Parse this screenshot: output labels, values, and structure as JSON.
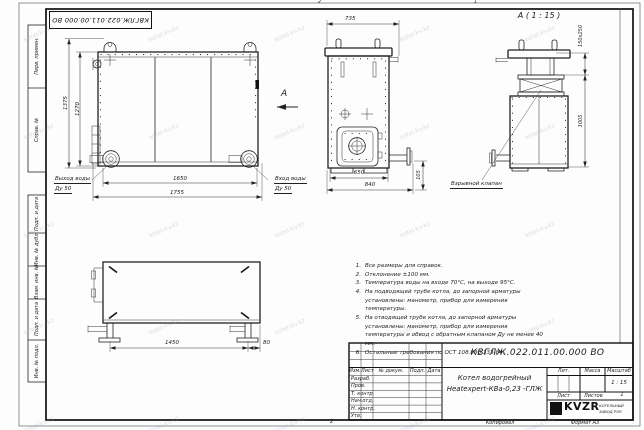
{
  "watermark": "kotel-kv.kz",
  "sheet": {
    "fold_marks": [
      "2",
      "1",
      "2"
    ]
  },
  "margin_labels": [
    "Перв. примен.",
    "Справ. №",
    "Подп. и дата",
    "Инв. № дубл.",
    "Взам. инв. №",
    "Подп. и дата",
    "Инв. № подл."
  ],
  "top_stamp": "КВГЛЖ.022.011.00.000 ВО",
  "front_view": {
    "dim_height_outer": "1375",
    "dim_height_inner": "1270",
    "dim_width_inner": "1650",
    "dim_width_outer": "1755",
    "outlet_line1": "Выход воды",
    "outlet_line2": "Ду 50",
    "inlet_line1": "Вход воды",
    "inlet_line2": "Ду 50",
    "section_arrow": "А"
  },
  "side_view": {
    "dim_top": "735",
    "dim_bottom_inner": "650",
    "dim_bottom_outer": "840",
    "dim_pipe_height": "105"
  },
  "detail_view": {
    "title": "А ( 1 : 15 )",
    "dim_valve": "150x250",
    "dim_body_height": "1005",
    "callout": "Взрывной клапан"
  },
  "plan_view": {
    "dim_feet_span": "1450",
    "dim_edge_offset": "80"
  },
  "notes": [
    {
      "num": "1.",
      "text": "Все размеры для справок."
    },
    {
      "num": "2.",
      "text": "Отклонение ±100 мм."
    },
    {
      "num": "3.",
      "text": "Температура воды на входе 70°С, на выходе 95°С."
    },
    {
      "num": "4.",
      "text": "На подводящей трубе котла, до запорной арматуры установлены: манометр, прибор для измерения температуры."
    },
    {
      "num": "5.",
      "text": "На отводящей трубе котла, до запорной арматуры установлены: манометр, прибор для измерения температуры и обвод с обратным клапаном Ду не менее 40 мм."
    },
    {
      "num": "6.",
      "text": "Остальные требования по ОСТ 108.030.133-84."
    }
  ],
  "title_block": {
    "doc_number": "КВГЛЖ.022.011.00.000 ВО",
    "name_line1": "Котел водогрейный",
    "name_line2": "Heatexpert-КВа-0,23 -ГЛЖ",
    "col_izm": "Изм.",
    "col_list": "Лист",
    "col_doc": "№ докум.",
    "col_podp": "Подп.",
    "col_data": "Дата",
    "rows": [
      "Разраб.",
      "Пров.",
      "Т. контр.",
      "Нач.отд.",
      "Н. контр.",
      "Утв."
    ],
    "lit_label": "Лит.",
    "mass_label": "Масса",
    "scale_label": "Масштаб",
    "scale_value": "1 : 15",
    "sheet_label": "Лист",
    "sheets_label": "Листов",
    "sheets_value": "1",
    "logo_text": "KVZR",
    "logo_sub1": "КОТЕЛЬНЫЙ",
    "logo_sub2": "ЗАВОД РЭП",
    "copy_label": "Копировал",
    "format_label": "Формат А3"
  }
}
